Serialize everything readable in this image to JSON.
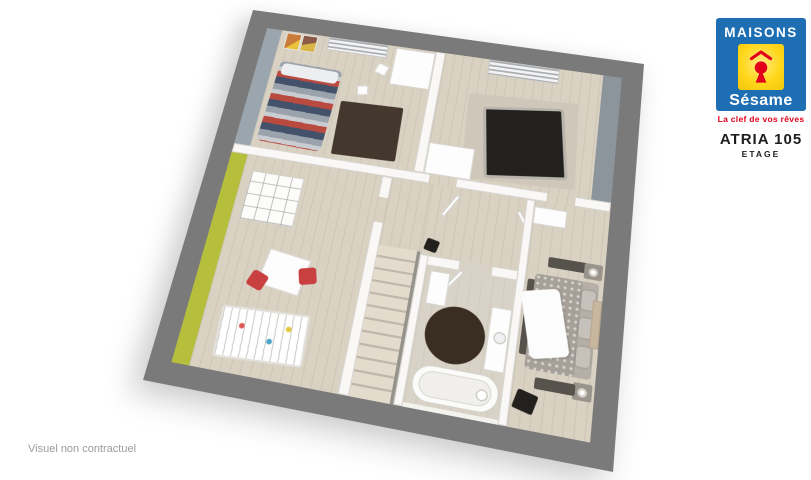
{
  "branding": {
    "logo_top": "MAISONS",
    "logo_script": "Sésame",
    "tagline": "La clef de vos rêves"
  },
  "plan": {
    "model_name": "ATRIA 105",
    "level_label": "ETAGE"
  },
  "footer": {
    "disclaimer": "Visuel non contractuel"
  },
  "colors": {
    "brand_blue": "#1e6eb4",
    "brand_yellow": "#ffd71c",
    "brand_red": "#e2001a",
    "text_dark": "#1d1d1b",
    "text_gray": "#9b9b9b",
    "frame_gray": "#7a7a7a",
    "floor_beige": "#d9d1c1",
    "accent_green": "#b5bf3b",
    "accent_bluegray": "#9aa5ae",
    "accent_gray_band": "#8d959c",
    "rug_dark_brown": "#44382e",
    "bed_stripe_red": "#b94a3f",
    "bed_stripe_navy": "#44516b",
    "bed_dark": "#23211f",
    "chair_red": "#c84040"
  }
}
